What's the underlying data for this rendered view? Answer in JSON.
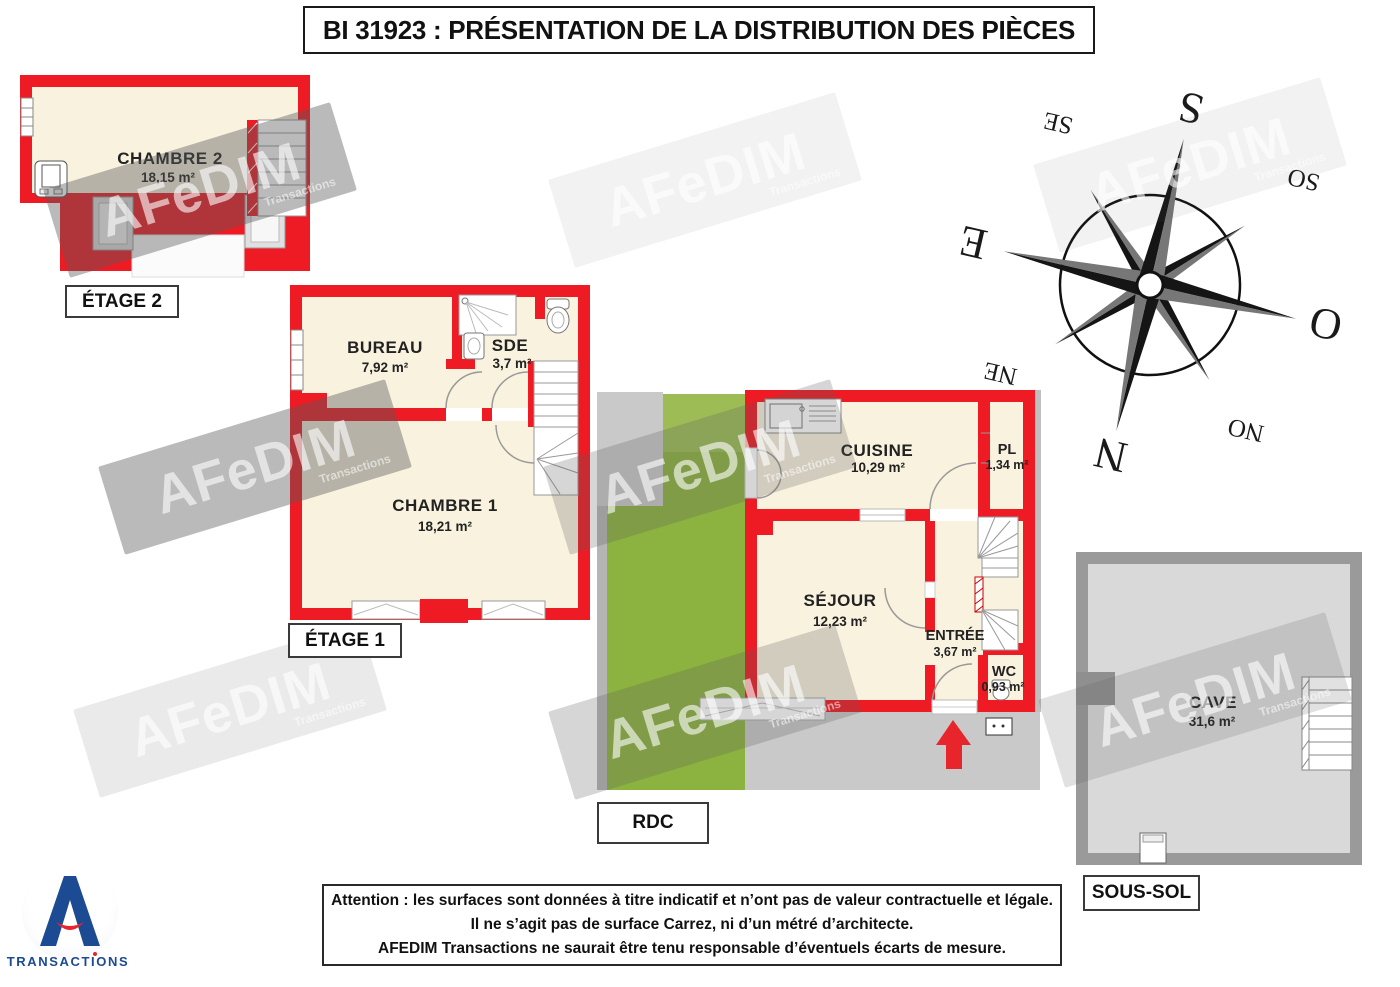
{
  "title": "BI 31923 : PRÉSENTATION DE LA DISTRIBUTION DES PIÈCES",
  "floors": {
    "etage2": {
      "label": "ÉTAGE 2",
      "rooms": {
        "chambre2": {
          "name": "CHAMBRE 2",
          "area": "18,15 m²"
        }
      }
    },
    "etage1": {
      "label": "ÉTAGE 1",
      "rooms": {
        "bureau": {
          "name": "BUREAU",
          "area": "7,92 m²"
        },
        "sde": {
          "name": "SDE",
          "area": "3,7 m²"
        },
        "chambre1": {
          "name": "CHAMBRE 1",
          "area": "18,21 m²"
        }
      }
    },
    "rdc": {
      "label": "RDC",
      "rooms": {
        "cuisine": {
          "name": "CUISINE",
          "area": "10,29 m²"
        },
        "pl": {
          "name": "PL",
          "area": "1,34 m²"
        },
        "sejour": {
          "name": "SÉJOUR",
          "area": "12,23 m²"
        },
        "entree": {
          "name": "ENTRÉE",
          "area": "3,67 m²"
        },
        "wc": {
          "name": "WC",
          "area": "0,93 m²"
        }
      }
    },
    "soussol": {
      "label": "SOUS-SOL",
      "rooms": {
        "cave": {
          "name": "CAVE",
          "area": "31,6 m²"
        }
      }
    }
  },
  "compass": {
    "n": "N",
    "s": "S",
    "e": "E",
    "o": "O",
    "ne": "NE",
    "se": "SE",
    "so": "SO",
    "no": "NO"
  },
  "watermark": {
    "text": "AFeDIM",
    "subtext": "Transactions"
  },
  "disclaimer": {
    "line1": "Attention : les surfaces sont données à titre indicatif et n’ont pas de valeur contractuelle et légale.",
    "line2": "Il ne s’agit pas de surface Carrez, ni d’un métré d’architecte.",
    "line3": "AFEDIM Transactions ne saurait être tenu responsable d’éventuels écarts de mesure."
  },
  "logo": {
    "text": "TRANSACTIONS"
  },
  "colors": {
    "wall_red": "#ee1b24",
    "floor_cream": "#f8f2de",
    "garden_green": "#8cb23f",
    "path_gray": "#c9c9c9",
    "basement_wall": "#9a9a9a",
    "basement_floor": "#d9d9d9",
    "logo_blue": "#1c4a93",
    "logo_red": "#e8252a"
  }
}
